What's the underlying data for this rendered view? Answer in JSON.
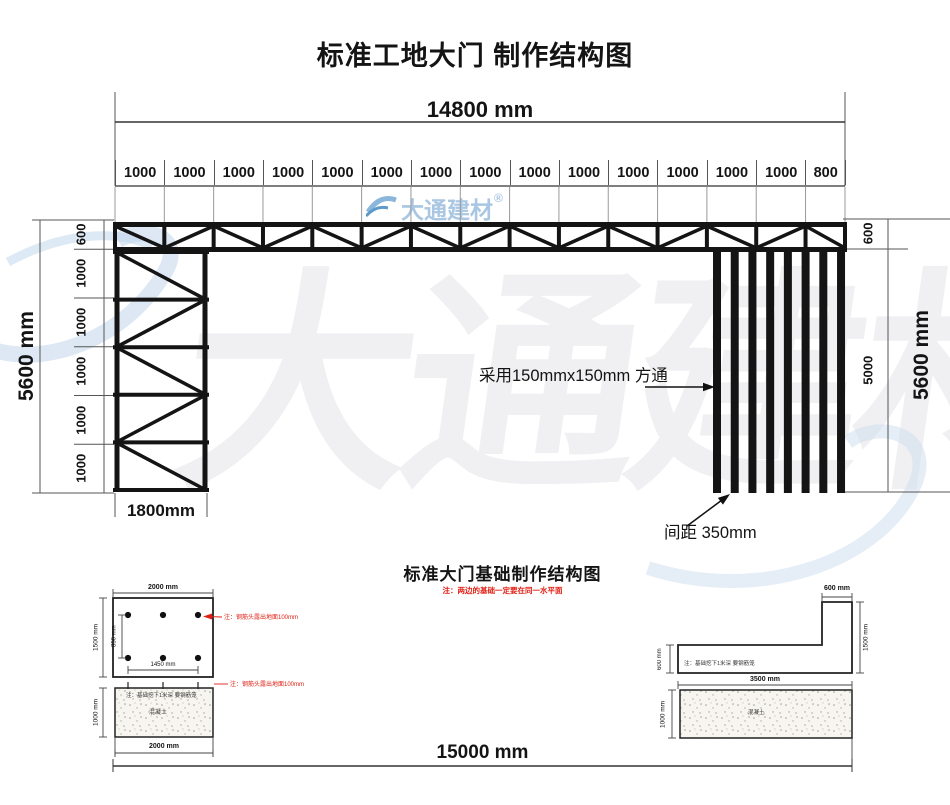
{
  "title": "标准工地大门 制作结构图",
  "watermark": {
    "brand": "大通建材",
    "registered": "®"
  },
  "gate": {
    "overall_width": "14800 mm",
    "top_segments": [
      "1000",
      "1000",
      "1000",
      "1000",
      "1000",
      "1000",
      "1000",
      "1000",
      "1000",
      "1000",
      "1000",
      "1000",
      "1000",
      "1000",
      "800"
    ],
    "left_overall": "5600 mm",
    "left_segments": [
      "600",
      "1000",
      "1000",
      "1000",
      "1000",
      "1000"
    ],
    "right_segments": [
      "600",
      "5000"
    ],
    "right_overall": "5600 mm",
    "column_width": "1800mm",
    "tube_note": "采用150mmx150mm 方通",
    "spacing_note": "间距 350mm"
  },
  "foundation": {
    "title": "标准大门基础制作结构图",
    "level_note": "注：两边的基础一定要在同一水平面",
    "left_plan": {
      "width": "2000 mm",
      "height": "1500 mm",
      "row_gap": "850 mm",
      "col_span": "1450 mm",
      "rebar_note": "注：钢筋头露出地面100mm"
    },
    "left_section": {
      "rebar_note": "注：钢筋头露出地面100mm",
      "dig_note": "注：基础挖下1米深 要钢筋笼",
      "material": "混凝土",
      "depth": "1000 mm",
      "width": "2000 mm"
    },
    "right_section": {
      "top_width": "600 mm",
      "right_height": "1500 mm",
      "left_height": "600 mm",
      "width": "3500 mm",
      "dig_note": "注：基础挖下1米深 要钢筋笼",
      "material": "混凝土",
      "depth": "1000 mm"
    },
    "overall_width": "15000 mm"
  },
  "colors": {
    "line": "#141414",
    "dim_line": "#555555",
    "note_red": "#e02015",
    "watermark_blue": "#a6c4e0",
    "watermark_gray": "#f0eff2"
  }
}
